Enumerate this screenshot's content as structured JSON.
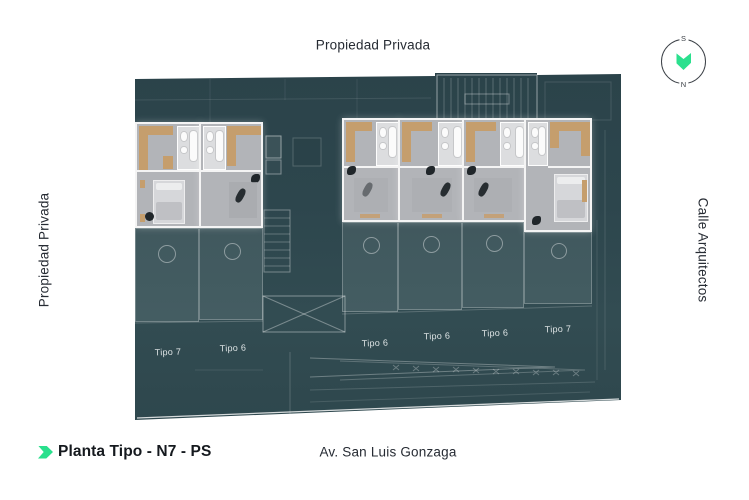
{
  "colors": {
    "plan_teal": "#2d464d",
    "accent_green": "#2be08e",
    "lit_floor_gray": "#b2b4b8",
    "kitchen_tan": "#c59e6d",
    "text_dark": "#23272e",
    "unit_label_light": "#dde3e4"
  },
  "surroundings": {
    "top": "Propiedad Privada",
    "left": "Propiedad Privada",
    "right": "Calle Arquitectos",
    "bottom": "Av. San Luis Gonzaga"
  },
  "compass": {
    "south": "S",
    "north": "N"
  },
  "title": {
    "label": "Planta Tipo - N7 - PS"
  },
  "units": [
    {
      "label": "Tipo 7"
    },
    {
      "label": "Tipo 6"
    },
    {
      "label": "Tipo 6"
    },
    {
      "label": "Tipo 6"
    },
    {
      "label": "Tipo 6"
    },
    {
      "label": "Tipo 7"
    }
  ]
}
